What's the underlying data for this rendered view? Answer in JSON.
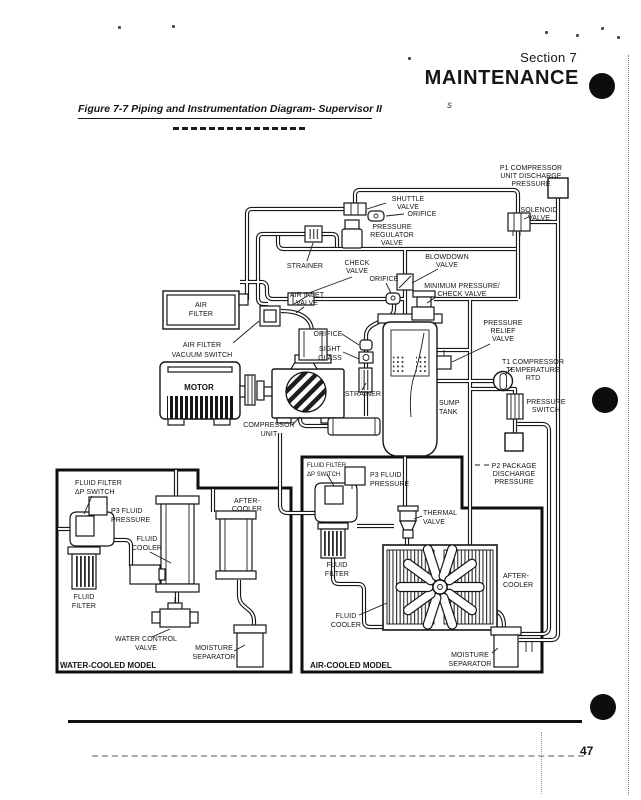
{
  "header": {
    "section": "Section 7",
    "title": "MAINTENANCE"
  },
  "caption": {
    "text": "Figure 7-7 Piping and Instrumentation Diagram- Supervisor II",
    "stray_mark": "s"
  },
  "footer": {
    "page_number": "47"
  },
  "colors": {
    "ink": "#161616",
    "paper": "#ffffff"
  },
  "diagram": {
    "labels": {
      "p1": [
        "P1 COMPRESSOR",
        "UNIT DISCHARGE",
        "PRESSURE"
      ],
      "shuttle": [
        "SHUTTLE",
        "VALVE"
      ],
      "orifice1": [
        "ORIFICE"
      ],
      "regulator": [
        "PRESSURE",
        "REGULATOR",
        "VALVE"
      ],
      "solenoid": [
        "SOLENOID",
        "VALVE"
      ],
      "strainer_top": [
        "STRAINER"
      ],
      "check_valve": [
        "CHECK",
        "VALVE"
      ],
      "blowdown": [
        "BLOWDOWN",
        "VALVE"
      ],
      "orifice2": [
        "ORIFICE"
      ],
      "min_pressure": [
        "MINIMUM PRESSURE/",
        "CHECK VALVE"
      ],
      "air_inlet": [
        "AIR INLET",
        "VALVE"
      ],
      "air_filter": [
        "AIR",
        "FILTER"
      ],
      "vacuum_switch": [
        "AIR FILTER",
        "VACUUM SWITCH"
      ],
      "orifice3": [
        "ORIFICE"
      ],
      "sight_glass": [
        "SIGHT",
        "GLASS"
      ],
      "relief": [
        "PRESSURE",
        "RELIEF",
        "VALVE"
      ],
      "motor": [
        "MOTOR"
      ],
      "strainer2": [
        "STRAINER"
      ],
      "compressor": [
        "COMPRESSOR",
        "UNIT"
      ],
      "sump": [
        "SUMP",
        "TANK"
      ],
      "t1": [
        "T1 COMPRESSOR",
        "TEMPERATURE",
        "RTD"
      ],
      "pressure_switch": [
        "PRESSURE",
        "SWITCH"
      ],
      "p2": [
        "P2 PACKAGE",
        "DISCHARGE",
        "PRESSURE"
      ]
    },
    "water_model": {
      "dp_switch": [
        "FLUID FILTER",
        "ΔP SWITCH"
      ],
      "p3": [
        "P3 FLUID",
        "PRESSURE"
      ],
      "fluid_cooler": [
        "FLUID",
        "COOLER"
      ],
      "after_cooler": [
        "AFTER-",
        "COOLER"
      ],
      "fluid_filter": [
        "FLUID",
        "FILTER"
      ],
      "water_valve": [
        "WATER CONTROL",
        "VALVE"
      ],
      "moisture": [
        "MOISTURE",
        "SEPARATOR"
      ],
      "title": "WATER-COOLED MODEL"
    },
    "air_model": {
      "dp_switch": [
        "FLUID FILTER",
        "ΔP SWITCH"
      ],
      "p3": [
        "P3 FLUID",
        "PRESSURE"
      ],
      "thermal": [
        "THERMAL",
        "VALVE"
      ],
      "fluid_filter": [
        "FLUID",
        "FILTER"
      ],
      "after_cooler": [
        "AFTER-",
        "COOLER"
      ],
      "fluid_cooler": [
        "FLUID",
        "COOLER"
      ],
      "moisture": [
        "MOISTURE",
        "SEPARATOR"
      ],
      "title": "AIR-COOLED MODEL"
    }
  }
}
